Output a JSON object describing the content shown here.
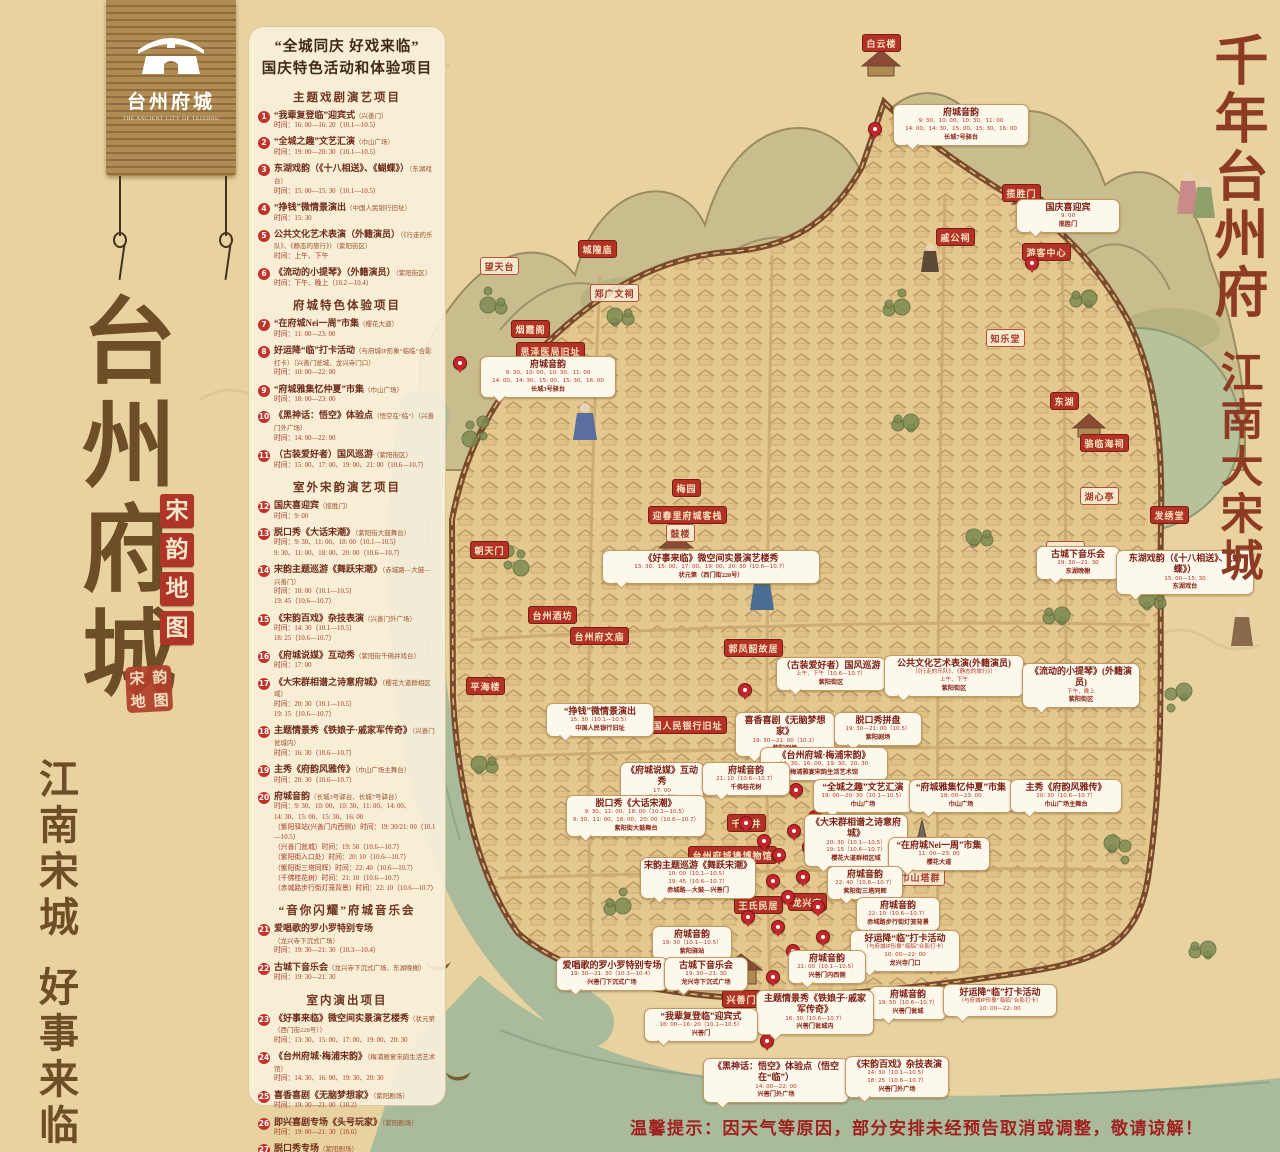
{
  "logo": {
    "title": "台州府城",
    "subtitle": "THE ANCIENT CITY OF TAIZHOU"
  },
  "left": {
    "title": "台州府城",
    "seal": "宋韵地图",
    "stamp": "宋韵地图",
    "bottom1": "江南宋城",
    "bottom2": "好事来临"
  },
  "right": {
    "l1": "千年台州府",
    "l2": "江南大宋城"
  },
  "notice": "温馨提示：因天气等原因，部分安排未经预告取消或调整，敬请谅解！",
  "colors": {
    "accent_red": "#b23226",
    "parchment": "#e8d3a0",
    "callout_border": "#c39a63",
    "ink_brown": "#6d4e27",
    "notice_red": "#a01f1f"
  },
  "panel": {
    "quote": "“全城同庆 好戏来临”",
    "subtitle": "国庆特色活动和体验项目",
    "sections": [
      {
        "title": "主题戏剧演艺项目",
        "items": [
          {
            "n": 1,
            "t": "“我辈复登临”迎宾式",
            "loc": "（兴善门）",
            "lines": [
              "时间：16: 00—16: 20（10.1—10.5）"
            ]
          },
          {
            "n": 2,
            "t": "“全城之趣”文艺汇演",
            "loc": "（巾山广场）",
            "lines": [
              "时间：19: 00—20: 30（10.1—10.5）"
            ]
          },
          {
            "n": 3,
            "t": "东湖戏韵（《十八相送》、《蝴蝶》）",
            "loc": "（东湖戏台）",
            "lines": [
              "时间：15: 00—15: 30（10.1—10.5）"
            ]
          },
          {
            "n": 4,
            "t": "“挣钱”微情景演出",
            "loc": "（中国人民银行旧址）",
            "lines": [
              "时间：15: 30"
            ]
          },
          {
            "n": 5,
            "t": "公共文化艺术表演（外籍演员）",
            "loc": "（《行走的乐队》、《静态的旅行》）（紫阳街区）",
            "lines": [
              "时间：上午、下午"
            ]
          },
          {
            "n": 6,
            "t": "《流动的小提琴》（外籍演员）",
            "loc": "（紫阳街区）",
            "lines": [
              "时间：下午、晚上（10.2—10.4）"
            ]
          }
        ]
      },
      {
        "title": "府城特色体验项目",
        "items": [
          {
            "n": 7,
            "t": "“在府城Nei一周”市集",
            "loc": "（樱花大道）",
            "lines": [
              "时间：11: 00—23: 00"
            ]
          },
          {
            "n": 8,
            "t": "好运降“临”打卡活动",
            "loc": "（与府城IP形象“临临”合影打卡）（兴善门瓮城、龙兴寺门口）",
            "lines": [
              "时间：10: 00—22: 00"
            ]
          },
          {
            "n": 9,
            "t": "“府城雅集忆仲夏”市集",
            "loc": "（巾山广场）",
            "lines": [
              "时间：18: 00—23: 00"
            ]
          },
          {
            "n": 10,
            "t": "《黑神话：悟空》体验点",
            "loc": "（悟空在“临”）（兴善门外广场）",
            "lines": [
              "时间：14: 00—22: 00"
            ]
          },
          {
            "n": 11,
            "t": "（古装爱好者）国风巡游",
            "loc": "（紫阳街区）",
            "lines": [
              "时间：15: 00、17: 00、19: 00、21: 00（10.6—10.7）"
            ]
          }
        ]
      },
      {
        "title": "室外宋韵演艺项目",
        "items": [
          {
            "n": 12,
            "t": "国庆喜迎宾",
            "loc": "（揽胜门）",
            "lines": [
              "时间：9: 00"
            ]
          },
          {
            "n": 13,
            "t": "脱口秀《大话宋潮》",
            "loc": "（紫阳街大鼓舞台）",
            "lines": [
              "时间：9: 30、11: 00、18: 00（10.1—10.5）",
              "9: 30、11: 00、18: 00、20: 00（10.6—10.7）"
            ]
          },
          {
            "n": 14,
            "t": "宋韵主题巡游《舞跃宋潮》",
            "loc": "（赤城路—大鼓—兴善门）",
            "lines": [
              "时间：10: 00（10.1—10.5）",
              "19: 45（10.6—10.7）"
            ]
          },
          {
            "n": 15,
            "t": "《宋韵百戏》杂技表演",
            "loc": "（兴善门外广场）",
            "lines": [
              "时间：14: 30（10.1—10.5）",
              "18: 25（10.6—10.7）"
            ]
          },
          {
            "n": 16,
            "t": "《府城说媒》互动秀",
            "loc": "（紫阳街千佛井戏台）",
            "lines": [
              "时间：17: 00"
            ]
          },
          {
            "n": 17,
            "t": "《大宋群相谱之诗意府城》",
            "loc": "（樱花大道群相区域）",
            "lines": [
              "时间：20: 30（10.1—10.5）",
              "19: 15（10.6—10.7）"
            ]
          },
          {
            "n": 18,
            "t": "主题情景秀《铁娘子·戚家军传奇》",
            "loc": "（兴善门瓮城内）",
            "lines": [
              "时间：16: 30（10.6—10.7）"
            ]
          },
          {
            "n": 19,
            "t": "主秀《府韵风雅传》",
            "loc": "（巾山广场主舞台）",
            "lines": [
              "时间：20: 30（10.6—10.7）"
            ]
          },
          {
            "n": 20,
            "t": "府城音韵",
            "loc": "（长城3号驿台、长城7号驿台）",
            "lines": [
              "时间：9: 30、10: 00、10: 30、11: 00、14: 00、",
              "14: 30、15: 00、15: 30、16: 00",
              "（紫阳驿站(兴善门内西侧)）时间：19: 30/21: 00（10.1—10.5）",
              "（兴善门瓮城）时间：19: 50（10.6—10.7）",
              "（紫阳街入口处）时间：20: 10（10.6—10.7）",
              "（紫阳街三塔同辉）时间：22: 40（10.6—10.7）",
              "（千佛桂花树）时间：21: 10（10.6—10.7）",
              "（赤城路步行街灯笼背景）时间：22: 10（10.6—10.7）"
            ]
          }
        ]
      },
      {
        "title": "“音你闪耀”府城音乐会",
        "items": [
          {
            "n": 21,
            "t": "爱唱歌的罗小罗特别专场",
            "loc": "（龙兴寺下沉式广场）",
            "lines": [
              "时间：19: 30—21: 30（10.3—10.4）"
            ]
          },
          {
            "n": 22,
            "t": "古城下音乐会",
            "loc": "（龙兴寺下沉式广场、东湖晚榭）",
            "lines": [
              "时间：19: 30—21: 30"
            ]
          }
        ]
      },
      {
        "title": "室内演出项目",
        "items": [
          {
            "n": 23,
            "t": "《好事来临》微空间实景演艺楼秀",
            "loc": "（状元第（西门街228号））",
            "lines": [
              "时间：13: 30、15: 00、17: 00、19: 00、20: 30"
            ]
          },
          {
            "n": 24,
            "t": "《台州府城·梅浦宋韵》",
            "loc": "（梅浦雅宴宋韵生活艺术馆）",
            "lines": [
              "时间：14: 30、16: 00、19: 30、20: 30"
            ]
          },
          {
            "n": 25,
            "t": "喜香喜剧《无脑梦想家》",
            "loc": "（紫阳剧场）",
            "lines": [
              "时间：19: 30—21: 00（10.2）"
            ]
          },
          {
            "n": 26,
            "t": "即兴喜剧专场《头号玩家》",
            "loc": "（紫阳剧场）",
            "lines": [
              "时间：19: 00—21: 30（10.6）"
            ]
          },
          {
            "n": 27,
            "t": "脱口秀专场",
            "loc": "（紫阳剧场）",
            "lines": [
              "时间：19: 30—21: 00（10.6、10.7）"
            ]
          }
        ]
      }
    ]
  },
  "map": {
    "labels": [
      {
        "t": "白云楼",
        "x": 862,
        "y": 34,
        "s": "r"
      },
      {
        "t": "揽胜门",
        "x": 1002,
        "y": 184,
        "s": "r"
      },
      {
        "t": "游客中心",
        "x": 1022,
        "y": 243,
        "s": "r"
      },
      {
        "t": "戚公祠",
        "x": 936,
        "y": 228,
        "s": "r"
      },
      {
        "t": "城隍庙",
        "x": 578,
        "y": 240,
        "s": "r"
      },
      {
        "t": "望天台",
        "x": 480,
        "y": 257,
        "s": "o"
      },
      {
        "t": "郑广文祠",
        "x": 590,
        "y": 284,
        "s": "o"
      },
      {
        "t": "烟霞阁",
        "x": 511,
        "y": 320,
        "s": "r"
      },
      {
        "t": "思泽医局旧址",
        "x": 516,
        "y": 342,
        "s": "r"
      },
      {
        "t": "知乐堂",
        "x": 986,
        "y": 329,
        "s": "o"
      },
      {
        "t": "东湖",
        "x": 1050,
        "y": 392,
        "s": "r"
      },
      {
        "t": "骆临海祠",
        "x": 1080,
        "y": 434,
        "s": "r"
      },
      {
        "t": "湖心亭",
        "x": 1080,
        "y": 487,
        "s": "o"
      },
      {
        "t": "发绣堂",
        "x": 1150,
        "y": 506,
        "s": "r"
      },
      {
        "t": "梅园",
        "x": 672,
        "y": 479,
        "s": "r"
      },
      {
        "t": "迎春里府城客栈",
        "x": 648,
        "y": 506,
        "s": "r"
      },
      {
        "t": "鼓楼",
        "x": 666,
        "y": 524,
        "s": "o"
      },
      {
        "t": "朝天门",
        "x": 470,
        "y": 541,
        "s": "r"
      },
      {
        "t": "崇和门",
        "x": 1046,
        "y": 541,
        "s": "o"
      },
      {
        "t": "台州酒坊",
        "x": 528,
        "y": 606,
        "s": "r"
      },
      {
        "t": "台州府文庙",
        "x": 570,
        "y": 627,
        "s": "r"
      },
      {
        "t": "郭凤韶故居",
        "x": 724,
        "y": 639,
        "s": "r"
      },
      {
        "t": "平海楼",
        "x": 466,
        "y": 677,
        "s": "r"
      },
      {
        "t": "中国人民银行旧址",
        "x": 638,
        "y": 716,
        "s": "r"
      },
      {
        "t": "千佛井",
        "x": 727,
        "y": 814,
        "s": "r"
      },
      {
        "t": "台州府城墙博物馆",
        "x": 688,
        "y": 846,
        "s": "r"
      },
      {
        "t": "巾山塔群",
        "x": 896,
        "y": 868,
        "s": "o"
      },
      {
        "t": "王氏民居",
        "x": 734,
        "y": 896,
        "s": "r"
      },
      {
        "t": "龙兴寺",
        "x": 788,
        "y": 893,
        "s": "r"
      },
      {
        "t": "兴善门",
        "x": 722,
        "y": 990,
        "s": "r"
      }
    ],
    "callouts": [
      {
        "x": 893,
        "y": 104,
        "w": 128,
        "t": "府城音韵",
        "lines": [
          "9: 30、10: 00、10: 30、11: 00",
          "14: 00、14: 30、15: 00、15: 30、16: 00"
        ],
        "loc": "长城7号驿台"
      },
      {
        "x": 1016,
        "y": 199,
        "w": 96,
        "t": "国庆喜迎宾",
        "lines": [
          "9: 00"
        ],
        "loc": "揽胜门"
      },
      {
        "x": 480,
        "y": 356,
        "w": 128,
        "t": "府城音韵",
        "lines": [
          "9: 30、10: 00、10: 30、11: 00",
          "14: 00、14: 30、15: 00、15: 30、16: 00"
        ],
        "loc": "长城3号驿台"
      },
      {
        "x": 602,
        "y": 550,
        "w": 210,
        "t": "《好事来临》微空间实景演艺楼秀",
        "lines": [
          "13: 30、15: 00、17: 00、19: 00、20: 30（10.6—10.7）"
        ],
        "loc": "状元第（西门街228号）"
      },
      {
        "x": 1036,
        "y": 546,
        "w": 76,
        "t": "古城下音乐会",
        "lines": [
          "19: 30—21: 30"
        ],
        "loc": "东湖晚榭"
      },
      {
        "x": 1116,
        "y": 550,
        "w": 130,
        "t": "东湖戏韵（《十八相送》、《蝴蝶》）",
        "lines": [
          "15: 00—15: 30"
        ],
        "loc": "东湖戏台"
      },
      {
        "x": 546,
        "y": 703,
        "w": 100,
        "t": "“挣钱”微情景演出",
        "lines": [
          "15: 30（10.1—10.5）"
        ],
        "loc": "中国人民银行旧址"
      },
      {
        "x": 776,
        "y": 657,
        "w": 102,
        "t": "（古装爱好者）国风巡游",
        "lines": [
          "上午、下午（10.6—10.7）"
        ],
        "loc": "紫阳街区"
      },
      {
        "x": 884,
        "y": 655,
        "w": 132,
        "t": "公共文化艺术表演(外籍演员)",
        "lines": [
          "（《行走的乐队》、《静态的旅行》）",
          "上午、下午"
        ],
        "loc": "紫阳街区"
      },
      {
        "x": 1022,
        "y": 663,
        "w": 110,
        "t": "《流动的小提琴》(外籍演员)",
        "lines": [
          "下午、晚上"
        ],
        "loc": "紫阳街区"
      },
      {
        "x": 735,
        "y": 712,
        "w": 92,
        "t": "喜香喜剧《无脑梦想家》",
        "lines": [
          "19: 30—21: 00（10.2）"
        ],
        "loc": "紫阳剧场"
      },
      {
        "x": 834,
        "y": 712,
        "w": 80,
        "t": "脱口秀拼盘",
        "lines": [
          "19: 30—21: 00（10.5）"
        ],
        "loc": "紫阳剧场"
      },
      {
        "x": 760,
        "y": 747,
        "w": 120,
        "t": "《台州府城·梅浦宋韵》",
        "lines": [
          "14: 30、16: 00、19: 30、20: 30"
        ],
        "loc": "梅浦雅宴宋韵生活艺术馆"
      },
      {
        "x": 813,
        "y": 779,
        "w": 92,
        "t": "“全城之趣”文艺汇演",
        "lines": [
          "19: 00—20: 30（10.1—10.5）"
        ],
        "loc": "巾山广场"
      },
      {
        "x": 909,
        "y": 779,
        "w": 96,
        "t": "“府城雅集忆仲夏”市集",
        "lines": [
          "18: 00—23: 00"
        ],
        "loc": "巾山广场"
      },
      {
        "x": 1010,
        "y": 779,
        "w": 104,
        "t": "主秀《府韵风雅传》",
        "lines": [
          "20: 30（10.6—10.7）"
        ],
        "loc": "巾山广场主舞台"
      },
      {
        "x": 804,
        "y": 814,
        "w": 96,
        "t": "《大宋群相谱之诗意府城》",
        "lines": [
          "20: 30（10.1—10.5）",
          "19: 15（10.6—10.7）"
        ],
        "loc": "樱花大道群相区域"
      },
      {
        "x": 888,
        "y": 837,
        "w": 94,
        "t": "“在府城Nei一周”市集",
        "lines": [
          "11: 00—23: 00"
        ],
        "loc": "樱花大道"
      },
      {
        "x": 827,
        "y": 866,
        "w": 68,
        "t": "府城音韵",
        "lines": [
          "22: 40（10.6—10.7）"
        ],
        "loc": "紫阳街三塔同辉"
      },
      {
        "x": 856,
        "y": 897,
        "w": 76,
        "t": "府城音韵",
        "lines": [
          "22: 10（10.6—10.7）"
        ],
        "loc": "赤城路步行街灯笼背景"
      },
      {
        "x": 850,
        "y": 930,
        "w": 102,
        "t": "好运降“临”打卡活动",
        "lines": [
          "（与府城IP形象“临临”合影打卡）",
          "10: 00—22: 00"
        ],
        "loc": "龙兴寺门口"
      },
      {
        "x": 620,
        "y": 762,
        "w": 76,
        "t": "《府城说媒》互动秀",
        "lines": [
          "17: 00"
        ],
        "loc": "千佛井戏台"
      },
      {
        "x": 702,
        "y": 762,
        "w": 80,
        "t": "府城音韵",
        "lines": [
          "21: 10（10.6—10.7）"
        ],
        "loc": "千佛桂花树"
      },
      {
        "x": 566,
        "y": 795,
        "w": 132,
        "t": "脱口秀《大话宋潮》",
        "lines": [
          "9: 30、11: 00、18: 00（10.1—10.5）",
          "9: 30、11: 00、18: 00、20: 00（10.6—10.7）"
        ],
        "loc": "紫阳街大鼓舞台"
      },
      {
        "x": 640,
        "y": 857,
        "w": 108,
        "t": "宋韵主题巡游《舞跃宋潮》",
        "lines": [
          "10: 00（10.1—10.5）",
          "19: 45（10.6—10.7）"
        ],
        "loc": "赤城路—大鼓—兴善门"
      },
      {
        "x": 652,
        "y": 926,
        "w": 72,
        "t": "府城音韵",
        "lines": [
          "19: 30（10.1—10.5）"
        ],
        "loc": "紫阳驿站"
      },
      {
        "x": 556,
        "y": 957,
        "w": 104,
        "t": "爱唱歌的罗小罗特别专场",
        "lines": [
          "19: 30—21: 30（10.3—10.4）"
        ],
        "loc": "兴善门下沉式广场"
      },
      {
        "x": 664,
        "y": 957,
        "w": 76,
        "t": "古城下音乐会",
        "lines": [
          "19: 30—21: 30"
        ],
        "loc": "龙兴寺下沉式广场"
      },
      {
        "x": 788,
        "y": 950,
        "w": 70,
        "t": "府城音韵",
        "lines": [
          "21: 00（10.1—10.5）"
        ],
        "loc": "兴善门内西侧"
      },
      {
        "x": 869,
        "y": 986,
        "w": 70,
        "t": "府城音韵",
        "lines": [
          "19: 50（10.6—10.7）"
        ],
        "loc": "兴善门瓮城"
      },
      {
        "x": 943,
        "y": 984,
        "w": 106,
        "t": "好运降“临”打卡活动",
        "lines": [
          "（与府城IP形象“临临”合影打卡）",
          "10: 00—22: 00"
        ],
        "loc": ""
      },
      {
        "x": 756,
        "y": 990,
        "w": 110,
        "t": "主题情景秀《铁娘子·戚家军传奇》",
        "lines": [
          "16: 30（10.6—10.7）"
        ],
        "loc": "兴善门瓮城内"
      },
      {
        "x": 644,
        "y": 1008,
        "w": 106,
        "t": "“我辈复登临”迎宾式",
        "lines": [
          "16: 00—16: 20（10.1—10.5）"
        ],
        "loc": "兴善门"
      },
      {
        "x": 703,
        "y": 1058,
        "w": 138,
        "t": "《黑神话：悟空》体验点（悟空在“临”）",
        "lines": [
          "14: 00—22: 00"
        ],
        "loc": "兴善门外广场"
      },
      {
        "x": 845,
        "y": 1056,
        "w": 96,
        "t": "《宋韵百戏》杂技表演",
        "lines": [
          "14: 30（10.1—10.5）",
          "18: 25（10.6—10.7）"
        ],
        "loc": "兴善门外广场"
      }
    ],
    "pins": [
      [
        874,
        128
      ],
      [
        1031,
        262
      ],
      [
        459,
        362
      ],
      [
        744,
        689
      ],
      [
        795,
        789
      ],
      [
        745,
        822
      ],
      [
        763,
        840
      ],
      [
        778,
        854
      ],
      [
        793,
        830
      ],
      [
        808,
        846
      ],
      [
        772,
        880
      ],
      [
        787,
        896
      ],
      [
        802,
        876
      ],
      [
        817,
        906
      ],
      [
        777,
        926
      ],
      [
        792,
        950
      ],
      [
        807,
        966
      ],
      [
        822,
        936
      ],
      [
        837,
        956
      ],
      [
        772,
        976
      ],
      [
        747,
        916
      ],
      [
        732,
        870
      ],
      [
        814,
        816
      ],
      [
        828,
        792
      ],
      [
        766,
        1040
      ],
      [
        930,
        963
      ]
    ]
  }
}
